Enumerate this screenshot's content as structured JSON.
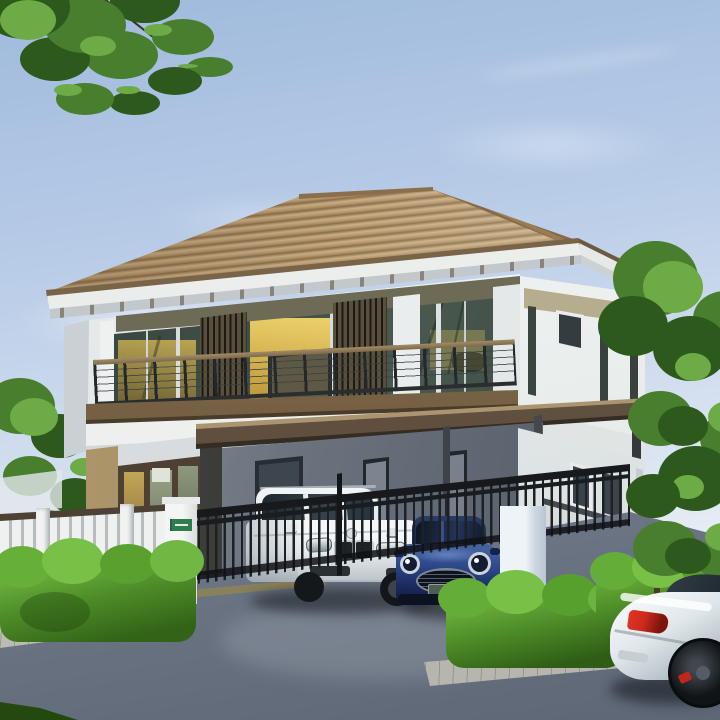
{
  "meta": {
    "title": "Daylight 3D exterior rendering of a modern two-storey detached house",
    "type": "architectural-visualization",
    "visible_text": []
  },
  "palette": {
    "sky_top": "#9fbadc",
    "sky_mid": "#cfdcee",
    "sky_low": "#eff3f6",
    "roof_tile": "#b49369",
    "roof_tile_dark": "#8a6f4c",
    "roof_tile_light": "#cbb086",
    "fascia_trim": "#7a6448",
    "fascia": "#f3f4f2",
    "soffit": "#c2c8cc",
    "wall_white": "#eef0f0",
    "wall_shadow": "#c9cfd3",
    "transom": "#6d6a56",
    "transom_light": "#b6ac8e",
    "glass_dark": "#2f3d37",
    "glass_mid": "#49594f",
    "glass_warm": "#e2c059",
    "glass_warm_dark": "#bb9638",
    "slat_base": "#57503e",
    "rail_wood": "#a28b67",
    "rail_dark": "#2a2e30",
    "balcony_band": "#86704f",
    "balcony_dark": "#4a3c2a",
    "canopy_top": "#ab9570",
    "canopy_face": "#6a5845",
    "canopy_edge": "#352c23",
    "carport_wall": "#6a727e",
    "tan_wall": "#b1996d",
    "tan_dark": "#8d7852",
    "door_frame": "#4e4133",
    "fence_dark": "#1d2124",
    "fence_rail": "#4c4134",
    "fence_white": "#eff1f1",
    "pillar_white": "#f2f3f2",
    "sign_green": "#2f7d4e",
    "hedge": "#4e8d28",
    "hedge_light": "#79c047",
    "hedge_dark": "#2f5d15",
    "tree": "#487e2e",
    "tree_light": "#6cab45",
    "tree_dark": "#2e591d",
    "drive_top": "#9ba4b1",
    "drive_low": "#5e6776",
    "curb": "#ccccc4",
    "suv_white": "#f1f4f6",
    "car_glass": "#263138",
    "mini_blue": "#2c4689",
    "mini_dark": "#131d3f",
    "coupe_white": "#ecf1f4",
    "tail_red": "#cc2a1d",
    "wheel_dark": "#111417",
    "grass": "#2f5c1e"
  },
  "scene": {
    "description": "Two-storey house with brown hip tiled roof, upper balcony with wood-capped railing and vertical slat screens, warm lit windows, ground floor carport sheltering a white SUV and a dark-blue MINI-style hatchback behind a dark metal fence, white gate pillars (left one with a small green address sign), trimmed bright hedges, trees left and right, grey driveway, and the rear of a white coupe passing in the lower-right corner.",
    "objects": [
      "sky",
      "clouds",
      "tree-branch-top-left",
      "background-trees-left",
      "hip-roof",
      "eaves",
      "upper-floor-facade",
      "balcony-railing",
      "slat-screens",
      "lit-windows",
      "balcony-band",
      "porch-glass-doors",
      "carport-canopy",
      "carport-wall",
      "white-suv",
      "blue-hatchback",
      "metal-fence",
      "white-picket-fence",
      "gate-pillars",
      "address-sign",
      "hedges",
      "curbs",
      "driveway",
      "tall-tree-right",
      "white-coupe",
      "lawn-corner"
    ]
  }
}
